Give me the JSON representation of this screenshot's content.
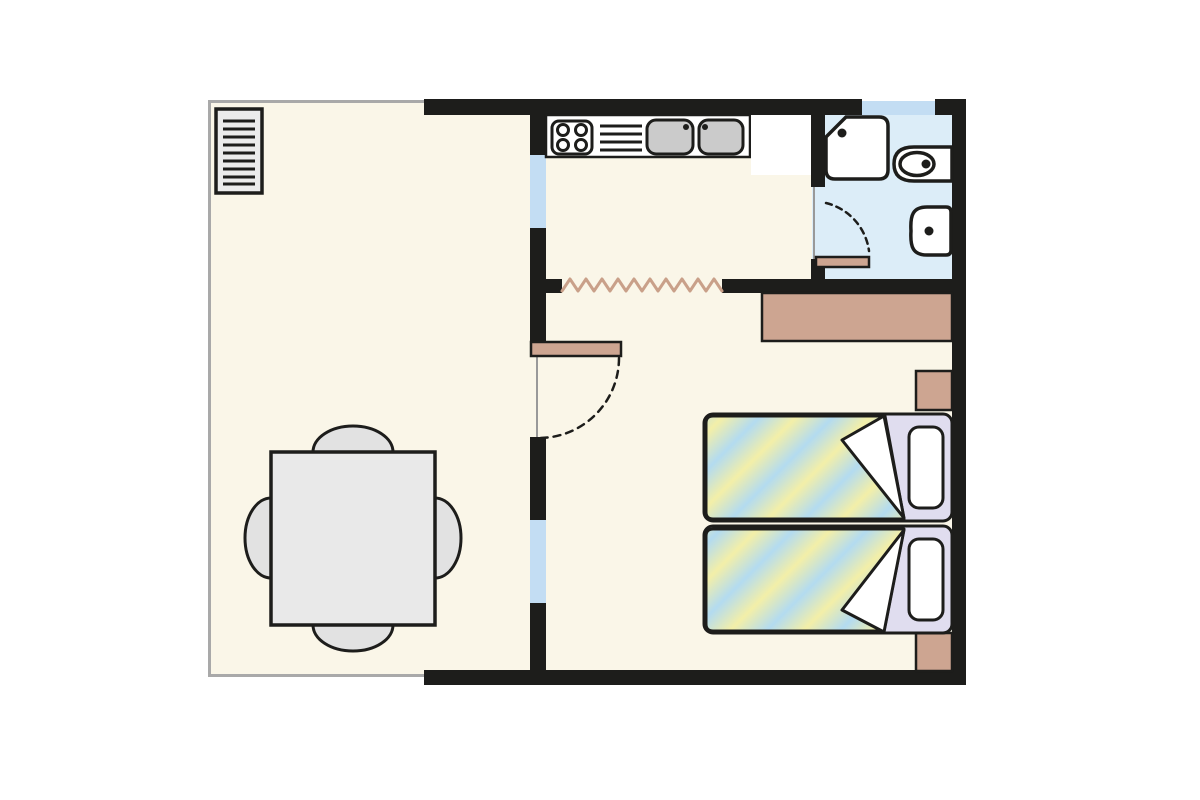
{
  "meta": {
    "type": "floor-plan",
    "description": "Apartment floor plan: terrace/living room with dining table, kitchen with counter, bathroom with shower toilet and washbasin, bedroom with two single beds"
  },
  "palette": {
    "background": "#ffffff",
    "wall": "#1d1d1b",
    "floor": "#faf6e8",
    "bath_floor": "#dcedf8",
    "window": "#c3ddf3",
    "wood": "#cda591",
    "wood_line": "#c9a089",
    "fixture_fill": "#ffffff",
    "sink_gray": "#cbcbcb",
    "table_fill": "#e9e9e9",
    "chair_fill": "#e2e2e2",
    "radiator_fill": "#ebebeb",
    "bed_head": "#e0ddef",
    "stripe_blue": "#b3dbf0",
    "stripe_yellow": "#f3efa8",
    "terrace_line": "#a9a9a9",
    "opening_line": "#999999"
  },
  "floors": [
    {
      "name": "terrace-floor",
      "x": 211,
      "y": 102,
      "w": 320,
      "h": 572,
      "fill": "floor"
    },
    {
      "name": "apartment-floor",
      "x": 546,
      "y": 113,
      "w": 406,
      "h": 558,
      "fill": "floor"
    },
    {
      "name": "bedroom-door-gap-floor",
      "x": 530,
      "y": 342,
      "w": 16,
      "h": 95,
      "fill": "floor"
    },
    {
      "name": "bathroom-floor",
      "x": 822,
      "y": 113,
      "w": 130,
      "h": 180,
      "fill": "bath_floor"
    },
    {
      "name": "bathroom-door-gap-floor",
      "x": 812,
      "y": 187,
      "w": 13,
      "h": 72,
      "fill": "bath_floor"
    }
  ],
  "windows": [
    {
      "name": "window-bathroom-top",
      "x": 862,
      "y": 101,
      "w": 73,
      "h": 14,
      "fill": "window"
    },
    {
      "name": "window-kitchen-west",
      "x": 530,
      "y": 155,
      "w": 16,
      "h": 73,
      "fill": "window"
    },
    {
      "name": "window-bedroom-west",
      "x": 530,
      "y": 520,
      "w": 16,
      "h": 83,
      "fill": "window"
    }
  ],
  "walls": [
    {
      "name": "wall-top-left",
      "x": 424,
      "y": 99,
      "w": 438,
      "h": 16,
      "fill": "wall"
    },
    {
      "name": "wall-top-right",
      "x": 935,
      "y": 99,
      "w": 31,
      "h": 16,
      "fill": "wall"
    },
    {
      "name": "wall-east",
      "x": 952,
      "y": 99,
      "w": 14,
      "h": 586,
      "fill": "wall"
    },
    {
      "name": "wall-bottom",
      "x": 424,
      "y": 670,
      "w": 542,
      "h": 15,
      "fill": "wall"
    },
    {
      "name": "wall-kitchen-west-a",
      "x": 530,
      "y": 99,
      "w": 16,
      "h": 56,
      "fill": "wall"
    },
    {
      "name": "wall-kitchen-west-b",
      "x": 530,
      "y": 228,
      "w": 16,
      "h": 114,
      "fill": "wall"
    },
    {
      "name": "wall-kitchen-west-c",
      "x": 530,
      "y": 437,
      "w": 16,
      "h": 83,
      "fill": "wall"
    },
    {
      "name": "wall-kitchen-west-d",
      "x": 530,
      "y": 603,
      "w": 16,
      "h": 82,
      "fill": "wall"
    },
    {
      "name": "wall-zigzag-stub",
      "x": 546,
      "y": 279,
      "w": 16,
      "h": 14,
      "fill": "wall"
    },
    {
      "name": "wall-bedroom-divider",
      "x": 722,
      "y": 279,
      "w": 230,
      "h": 14,
      "fill": "wall"
    },
    {
      "name": "wall-bathroom-west-a",
      "x": 811,
      "y": 113,
      "w": 14,
      "h": 74,
      "fill": "wall"
    },
    {
      "name": "wall-bathroom-west-b",
      "x": 811,
      "y": 259,
      "w": 14,
      "h": 34,
      "fill": "wall"
    }
  ],
  "thin_lines": [
    {
      "name": "terrace-edge-left",
      "x": 208,
      "y": 100,
      "w": 3,
      "h": 577,
      "fill": "terrace_line"
    },
    {
      "name": "terrace-edge-top",
      "x": 208,
      "y": 100,
      "w": 216,
      "h": 3,
      "fill": "terrace_line"
    },
    {
      "name": "terrace-edge-bottom",
      "x": 208,
      "y": 674,
      "w": 216,
      "h": 3,
      "fill": "terrace_line"
    },
    {
      "name": "bedroom-door-opening-line",
      "x": 536,
      "y": 355,
      "w": 2,
      "h": 82,
      "fill": "opening_line"
    },
    {
      "name": "bathroom-door-opening-line",
      "x": 813,
      "y": 187,
      "w": 2,
      "h": 72,
      "fill": "opening_line"
    }
  ],
  "furniture_blocks": [
    {
      "name": "kitchen-counter",
      "x": 546,
      "y": 115,
      "w": 204,
      "h": 42,
      "fill": "fixture_fill",
      "stroke": true
    },
    {
      "name": "kitchen-appliance-block",
      "x": 751,
      "y": 115,
      "w": 60,
      "h": 60,
      "fill": "fixture_fill",
      "stroke": false
    },
    {
      "name": "wardrobe",
      "x": 762,
      "y": 293,
      "w": 190,
      "h": 48,
      "fill": "wood",
      "stroke": true
    },
    {
      "name": "nightstand-upper",
      "x": 916,
      "y": 371,
      "w": 36,
      "h": 39,
      "fill": "wood",
      "stroke": true
    },
    {
      "name": "nightstand-lower",
      "x": 916,
      "y": 633,
      "w": 36,
      "h": 38,
      "fill": "wood",
      "stroke": true
    },
    {
      "name": "bedroom-door-leaf",
      "x": 531,
      "y": 342,
      "w": 90,
      "h": 14,
      "fill": "wood",
      "stroke": true
    },
    {
      "name": "bathroom-door-leaf",
      "x": 816,
      "y": 257,
      "w": 53,
      "h": 10,
      "fill": "wood",
      "stroke": true
    }
  ]
}
